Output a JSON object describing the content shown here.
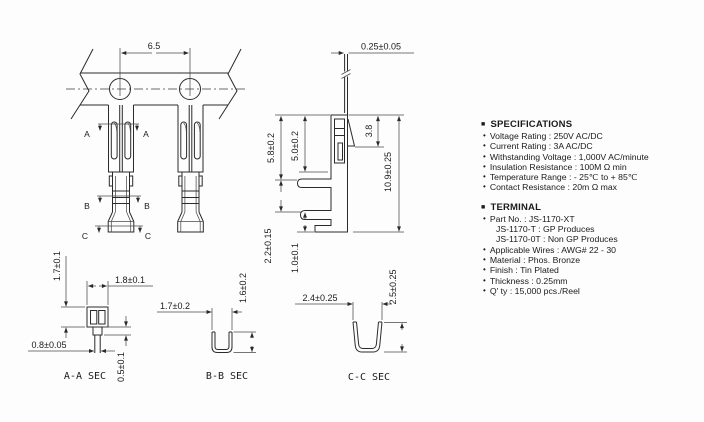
{
  "glyphs": {
    "section_marker": "■",
    "bullet": "•"
  },
  "specifications": {
    "title": "SPECIFICATIONS",
    "items": [
      "Voltage Rating : 250V AC/DC",
      "Current Rating : 3A AC/DC",
      "Withstanding Voltage : 1,000V AC/minute",
      "Insulation Resistance : 100M Ω min",
      "Temperature Range : - 25℃ to + 85℃",
      "Contact Resistance : 20m Ω max"
    ]
  },
  "terminal_info": {
    "title": "TERMINAL",
    "part_no": "Part No. : JS-1170-XT",
    "part_variants": [
      "JS-1170-T : GP Produces",
      "JS-1170-0T : Non GP Produces"
    ],
    "items": [
      "Applicable Wires : AWG# 22 - 30",
      "Material : Phos. Bronze",
      "Finish : Tin Plated",
      "Thickness : 0.25mm",
      "Q' ty : 15,000 pcs./Reel"
    ]
  },
  "dimensions": {
    "front": {
      "pitch": "6.5",
      "sec_a": "A",
      "sec_b": "B",
      "sec_c": "C"
    },
    "side": {
      "strip_thickness": "0.25±0.05",
      "box_height_outer": "5.8±0.2",
      "box_height_inner": "5.0±0.2",
      "lance_height": "3.8",
      "total_height": "10.9±0.25",
      "crimp_height": "2.2±0.15",
      "tail_height": "1.0±0.1"
    },
    "section_aa": {
      "label": "A-A SEC",
      "width": "1.8±0.1",
      "height": "1.7±0.1",
      "tail_width": "0.8±0.05",
      "stem_height": "0.5±0.1"
    },
    "section_bb": {
      "label": "B-B SEC",
      "width": "1.7±0.2",
      "height": "1.6±0.2"
    },
    "section_cc": {
      "label": "C-C SEC",
      "width": "2.4±0.25",
      "height": "2.5±0.25"
    }
  }
}
